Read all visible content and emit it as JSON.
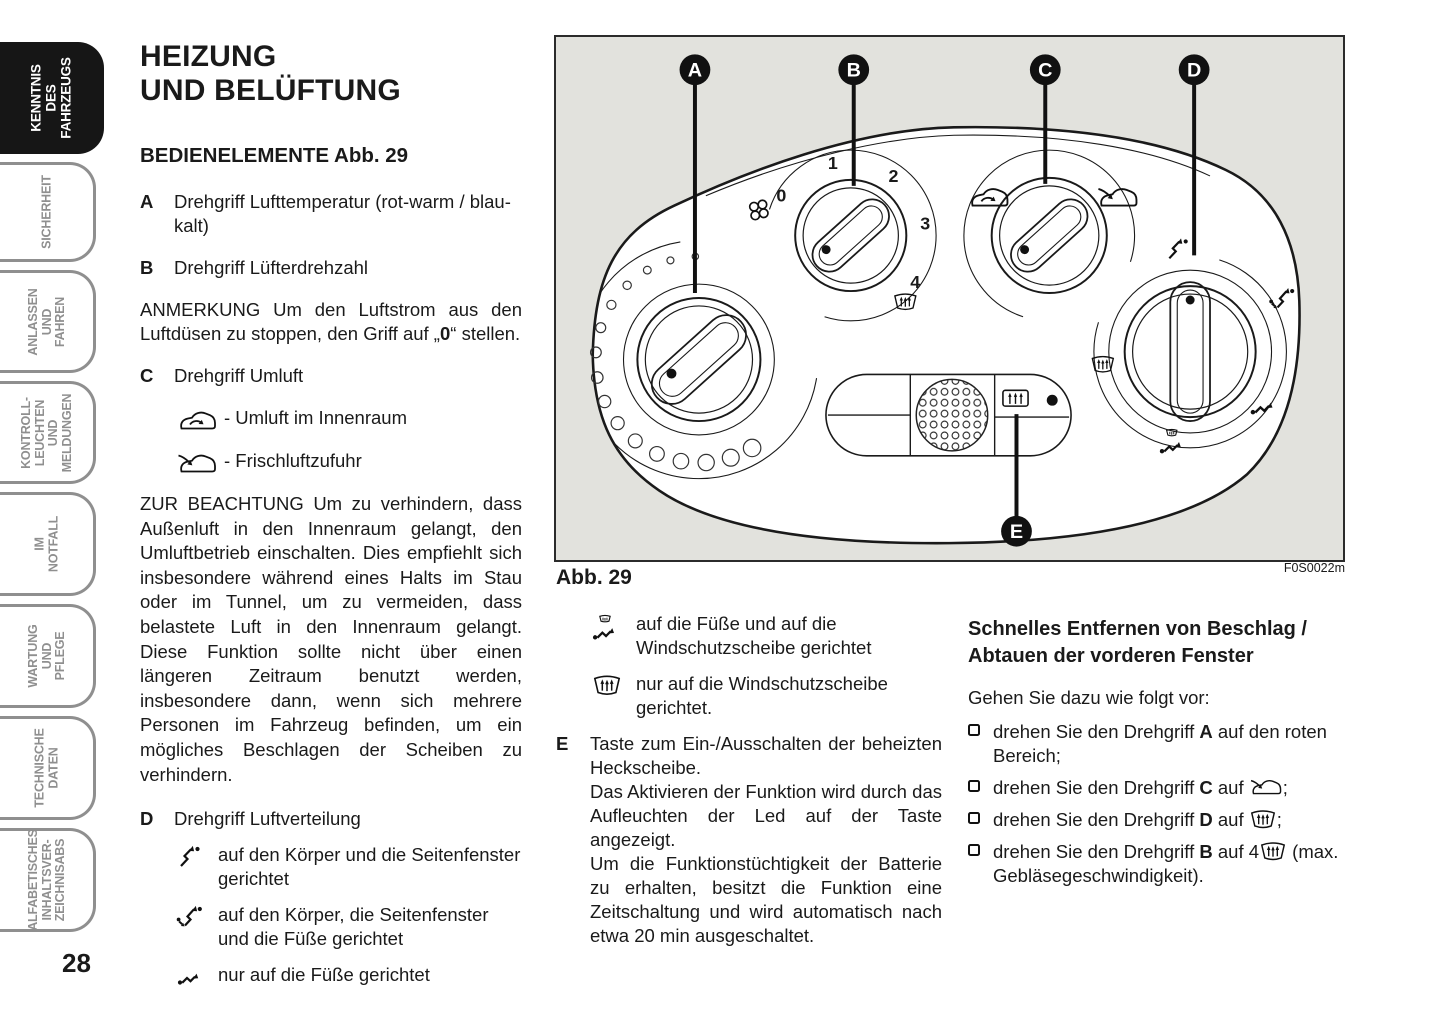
{
  "page_number": "28",
  "colors": {
    "ink": "#1a1a1a",
    "tab_inactive": "#8f8f8f",
    "tab_active_bg": "#161616",
    "figure_bg": "#e2e2dd"
  },
  "sidebar": {
    "tabs": [
      {
        "label": "KENNTNIS DES\nFAHRZEUGS",
        "active": true
      },
      {
        "label": "SICHERHEIT",
        "active": false
      },
      {
        "label": "ANLASSEN\nUND FAHREN",
        "active": false
      },
      {
        "label": "KONTROLL-\nLEUCHTEN UND\nMELDUNGEN",
        "active": false
      },
      {
        "label": "IM NOTFALL",
        "active": false
      },
      {
        "label": "WARTUNG\nUND PFLEGE",
        "active": false
      },
      {
        "label": "TECHNISCHE\nDATEN",
        "active": false
      },
      {
        "label": "ALFABETISCHES\nINHALTSVER-\nZEICHNISABS",
        "active": false
      }
    ]
  },
  "left": {
    "title": "HEIZUNG\nUND BELÜFTUNG",
    "subtitle": "BEDIENELEMENTE Abb. 29",
    "item_a": {
      "key": "A",
      "text": "Drehgriff Lufttemperatur (rot-warm / blau-kalt)"
    },
    "item_b": {
      "key": "B",
      "text": "Drehgriff Lüfterdrehzahl"
    },
    "note_pre": "ANMERKUNG Um den Luftstrom aus den Luftdüsen zu stoppen, den Griff auf „",
    "note_bold": "0",
    "note_post": "“ stellen.",
    "item_c": {
      "key": "C",
      "text": "Drehgriff Umluft"
    },
    "c_options": [
      {
        "icon": "car-recirculation-icon",
        "text": "- Umluft im Innenraum"
      },
      {
        "icon": "car-fresh-air-icon",
        "text": "- Frischluftzufuhr"
      }
    ],
    "warning": "ZUR BEACHTUNG Um zu verhindern, dass Außenluft in den Innenraum gelangt, den Umluftbetrieb einschalten. Dies empfiehlt sich insbesondere während eines Halts im Stau oder im Tunnel, um zu vermeiden, dass belastete Luft in den Innenraum gelangt. Diese Funktion sollte nicht über einen längeren Zeitraum benutzt werden, insbesondere dann, wenn sich mehrere Personen im Fahrzeug befinden, um ein mögliches Beschlagen der Scheiben zu verhindern.",
    "item_d": {
      "key": "D",
      "text": "Drehgriff Luftverteilung"
    },
    "d_options": [
      {
        "icon": "air-to-body-icon",
        "text": "auf den Körper und die Seitenfenster gerichtet"
      },
      {
        "icon": "air-to-body-and-feet-icon",
        "text": "auf den Körper, die Seitenfenster und die Füße gerichtet"
      },
      {
        "icon": "air-to-feet-icon",
        "text": "nur auf die Füße gerichtet"
      }
    ]
  },
  "middle": {
    "options": [
      {
        "icon": "air-to-feet-and-windshield-icon",
        "text": "auf die Füße und auf die Windschutzscheibe gerichtet"
      },
      {
        "icon": "windshield-defrost-icon",
        "text": "nur auf die Windschutzscheibe gerichtet."
      }
    ],
    "item_e": {
      "key": "E",
      "paragraphs": [
        "Taste zum Ein-/Ausschalten der beheizten Heckscheibe.",
        "Das Aktivieren der Funktion wird durch das Aufleuchten der Led auf der Taste angezeigt.",
        "Um die Funktionstüchtigkeit der Batterie zu erhalten, besitzt die Funktion eine Zeitschaltung und wird automatisch nach etwa 20 min ausgeschaltet."
      ]
    }
  },
  "right": {
    "heading": "Schnelles Entfernen von Beschlag / Abtauen der vorderen Fenster",
    "intro": "Gehen Sie dazu wie folgt vor:",
    "steps": [
      {
        "pre": "drehen Sie den Drehgriff ",
        "key": "A",
        "mid": " auf den roten Bereich;",
        "post": ""
      },
      {
        "pre": "drehen Sie den Drehgriff ",
        "key": "C",
        "mid": " auf ",
        "post": ";"
      },
      {
        "pre": "drehen Sie den Drehgriff ",
        "key": "D",
        "mid": " auf ",
        "post": ";"
      },
      {
        "pre": "drehen Sie den Drehgriff ",
        "key": "B",
        "mid": " auf 4",
        "post": " (max. Gebläsegeschwindigkeit)."
      }
    ]
  },
  "figure": {
    "caption": "Abb. 29",
    "code": "F0S0022m",
    "callouts": [
      "A",
      "B",
      "C",
      "D",
      "E"
    ],
    "fan_ticks": [
      "0",
      "1",
      "2",
      "3",
      "4"
    ]
  }
}
